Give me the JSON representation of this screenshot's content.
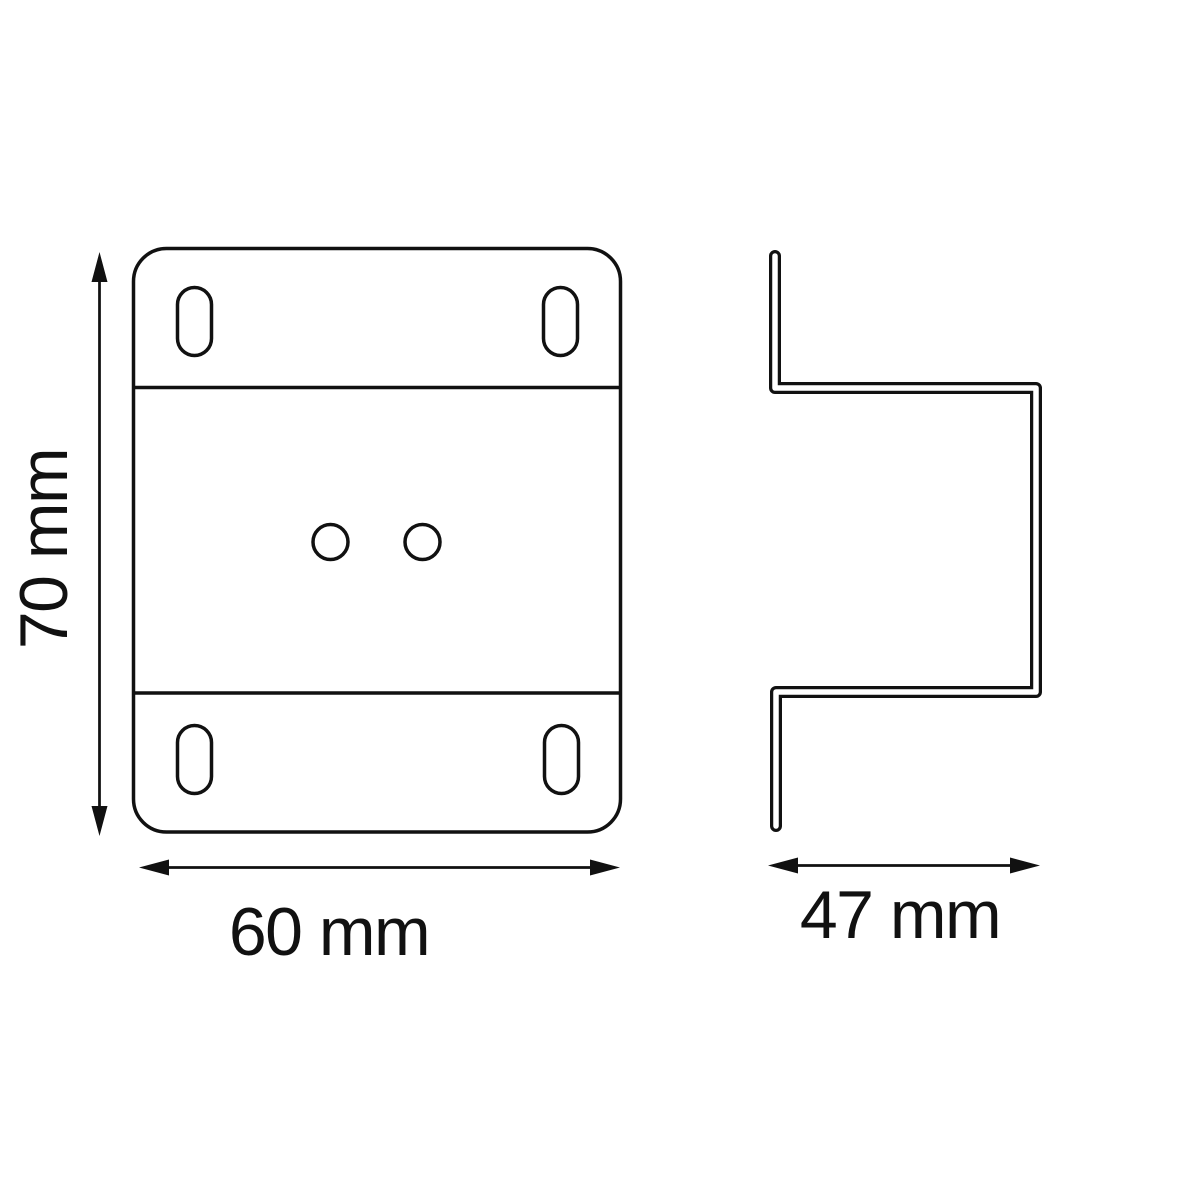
{
  "drawing": {
    "type": "technical-drawing",
    "subject": "mounting bracket",
    "background_color": "#ffffff",
    "line_color": "#111111",
    "views": {
      "front": {
        "name": "front-view",
        "mounting_slot_count": 4,
        "center_hole_count": 2,
        "bend_line_count": 2
      },
      "side": {
        "name": "side-profile-view"
      }
    },
    "dimensions": {
      "height": {
        "label": "70 mm",
        "value": 70,
        "unit": "mm"
      },
      "width": {
        "label": "60 mm",
        "value": 60,
        "unit": "mm"
      },
      "depth": {
        "label": "47 mm",
        "value": 47,
        "unit": "mm"
      }
    }
  }
}
